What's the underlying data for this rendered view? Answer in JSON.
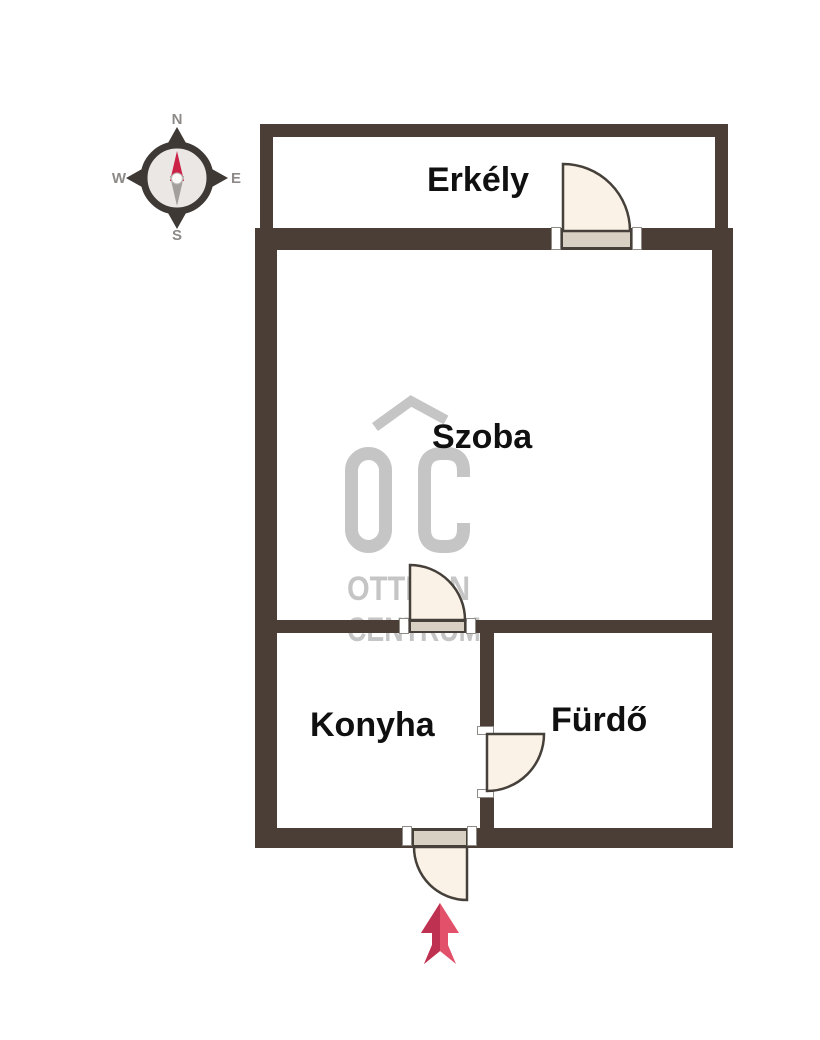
{
  "plan": {
    "rooms": [
      {
        "name": "Erkély"
      },
      {
        "name": "Szoba"
      },
      {
        "name": "Konyha"
      },
      {
        "name": "Fürdő"
      }
    ],
    "doors": [
      "balcony-door",
      "room-door",
      "bathroom-door",
      "entrance-door"
    ],
    "entrance_marker": "red-up-arrow"
  },
  "compass": {
    "north": "N",
    "east": "E",
    "south": "S",
    "west": "W"
  },
  "watermark": {
    "logo": "OC",
    "line1": "OTTHON",
    "line2": "CENTRUM"
  },
  "colors": {
    "wall": "#4b3e37",
    "door_fill": "#faf2e7",
    "door_stroke": "#46403b",
    "threshold": "#d8d0c3",
    "watermark_gray": "#c5c5c5",
    "label_black": "#101010",
    "arrow_light": "#e25169",
    "arrow_dark": "#bf3150",
    "compass_needle_red": "#cb2347",
    "compass_needle_gray": "#a39f9c"
  }
}
